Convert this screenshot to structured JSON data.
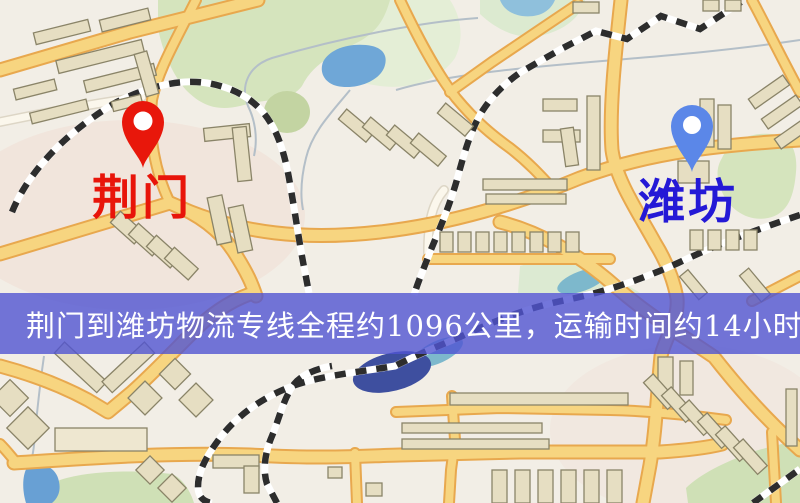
{
  "map": {
    "origin": {
      "name": "荆门",
      "label_color": "#e8150a",
      "pin": {
        "icon": "map-pin",
        "color": "#e8170b"
      }
    },
    "destination": {
      "name": "潍坊",
      "label_color": "#2419d6",
      "pin": {
        "icon": "map-pin",
        "color": "#5b87e8"
      }
    },
    "palette": {
      "background": "#f2eee6",
      "road_fill": "#f7d580",
      "road_casing": "#e8a84e",
      "minor_road": "#fbf7ec",
      "railway": "#2d2d2d",
      "building": "#e6dec2",
      "park_green": "#d5e4bd",
      "water_blue": "#6fa7d7",
      "river_navy": "#3e4f9f"
    }
  },
  "banner": {
    "text": "荆门到潍坊物流专线全程约1096公里，运输时间约14小时18分钟.",
    "background": "#5054d2",
    "text_color": "#ffffff"
  }
}
